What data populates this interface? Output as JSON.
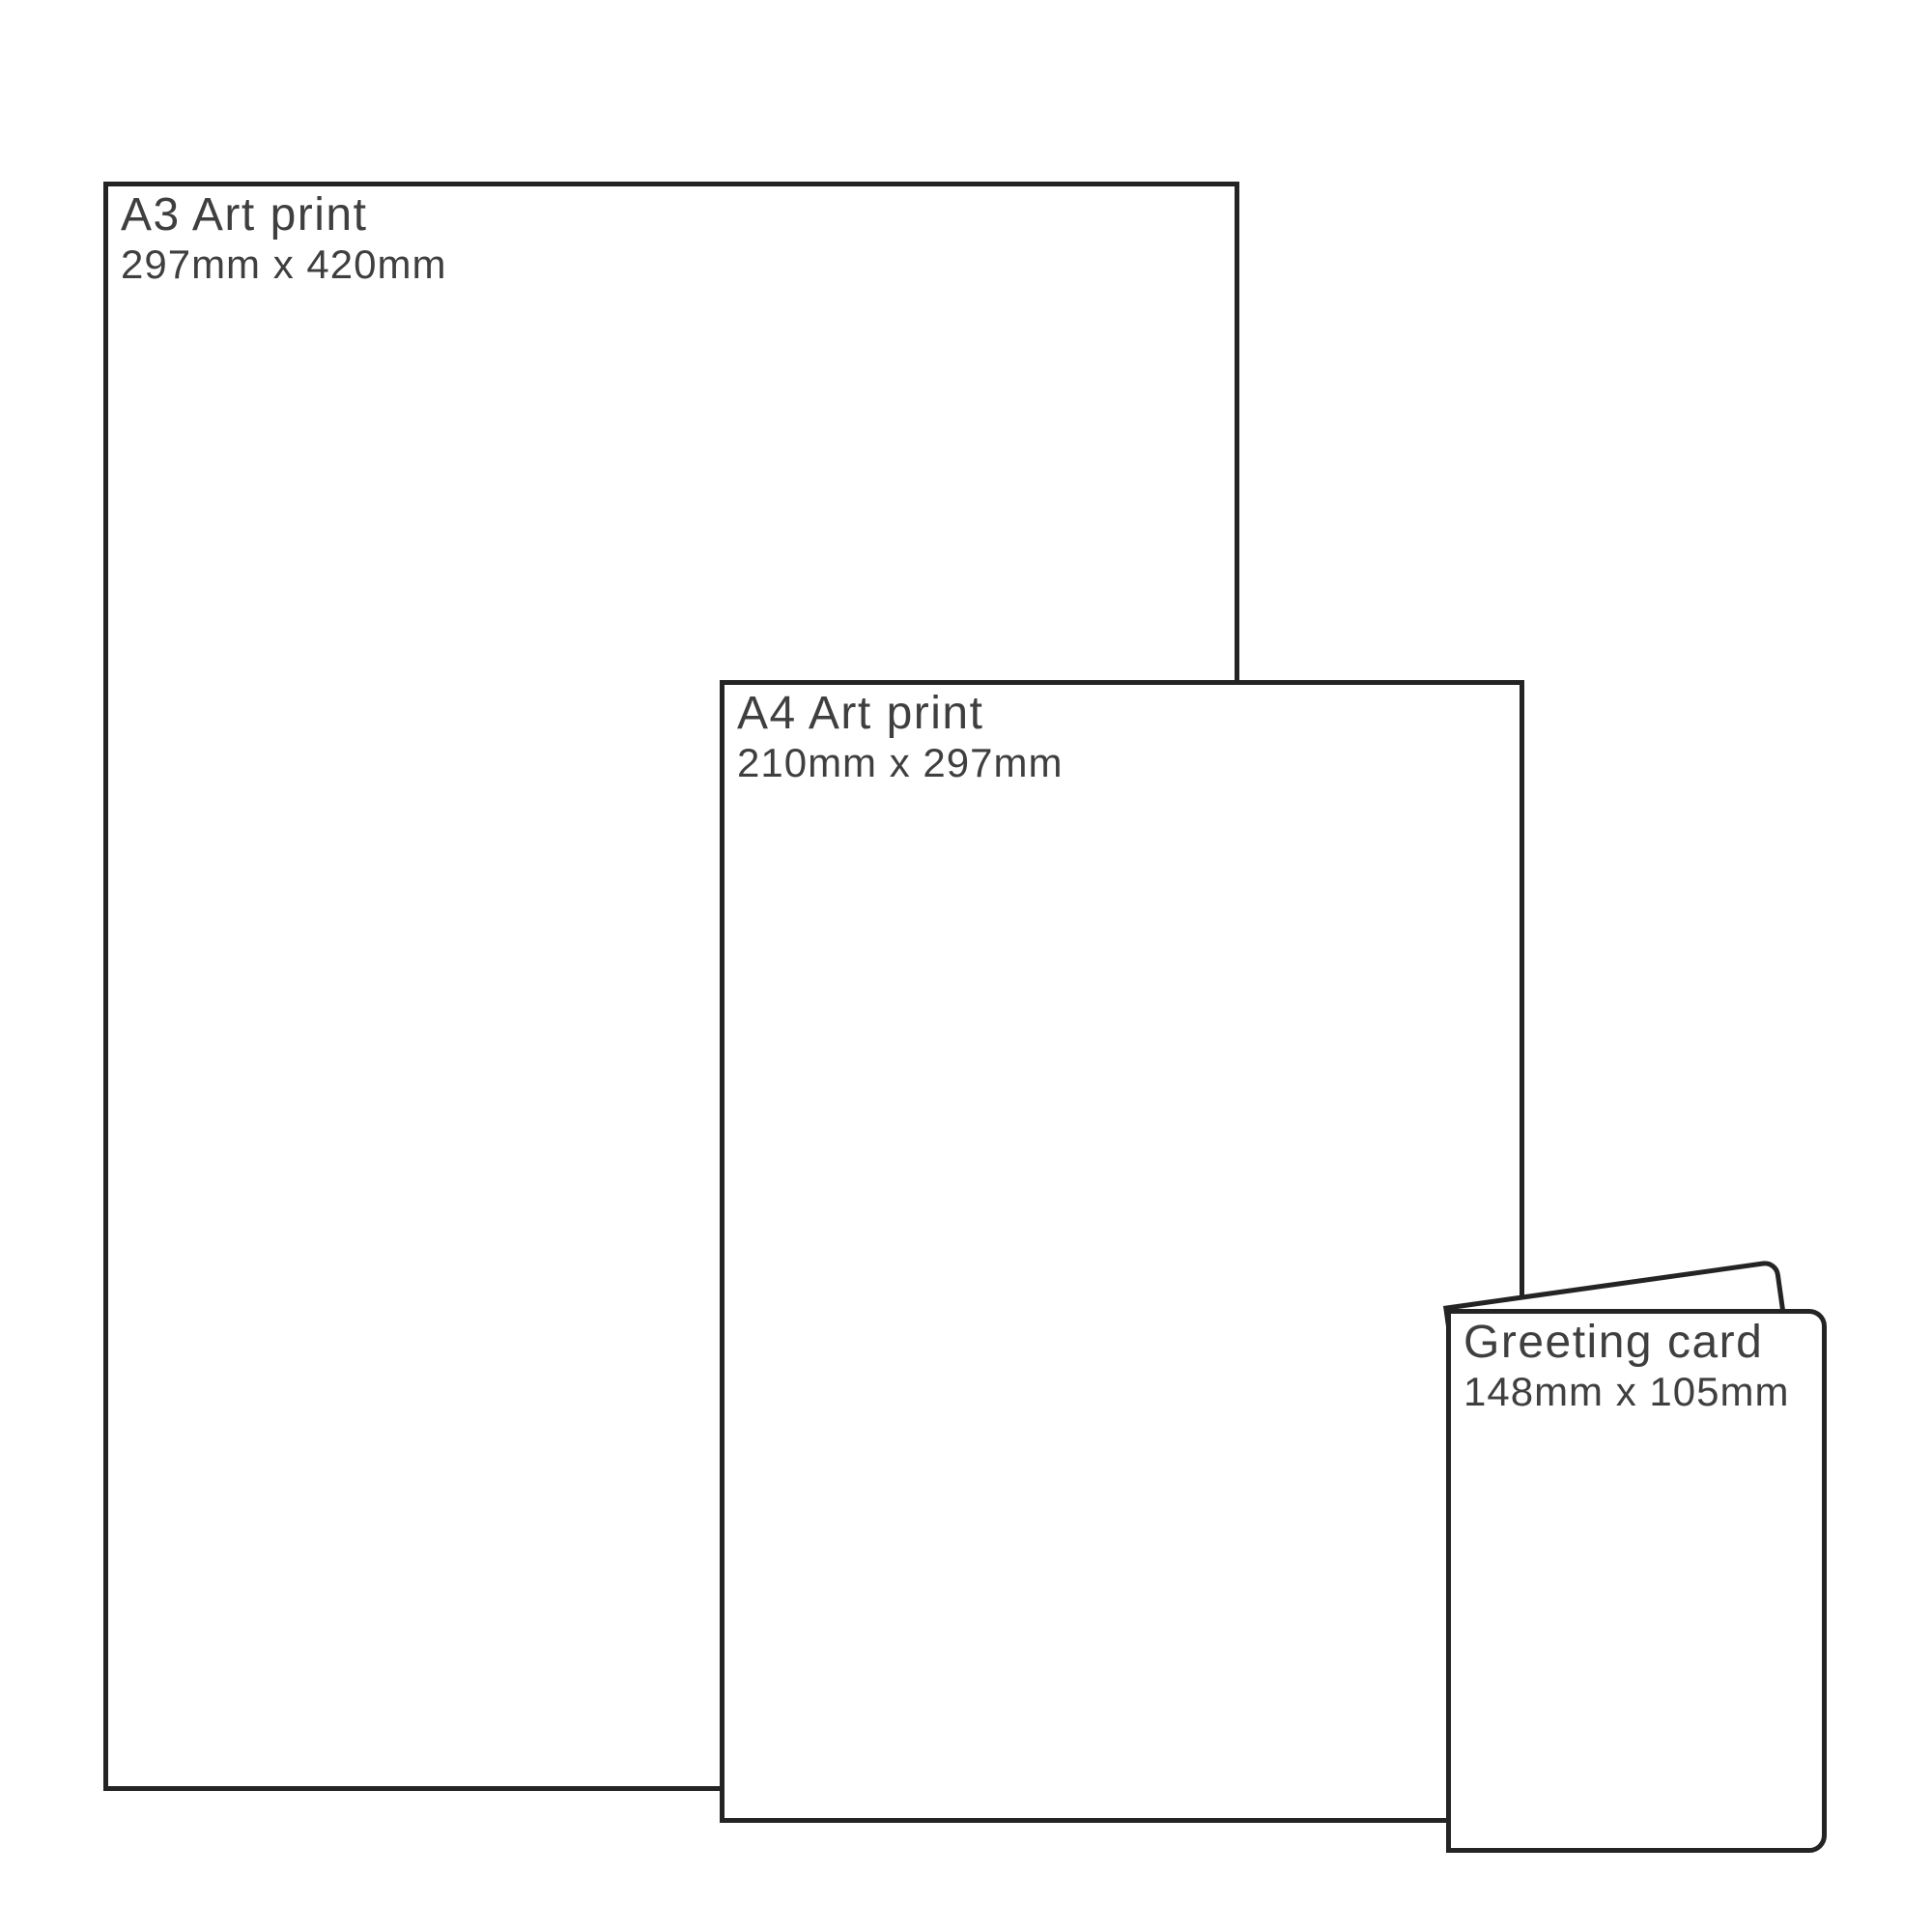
{
  "diagram_type": "print-size-comparison",
  "colors": {
    "outline": "#242424",
    "text": "#3f3f3f",
    "background": "#ffffff"
  },
  "items": [
    {
      "id": "a3-art-print",
      "title": "A3 Art print",
      "size": "297mm x 420mm"
    },
    {
      "id": "a4-art-print",
      "title": "A4 Art print",
      "size": "210mm x 297mm"
    },
    {
      "id": "greeting-card",
      "title": "Greeting card",
      "size": "148mm x 105mm"
    }
  ]
}
